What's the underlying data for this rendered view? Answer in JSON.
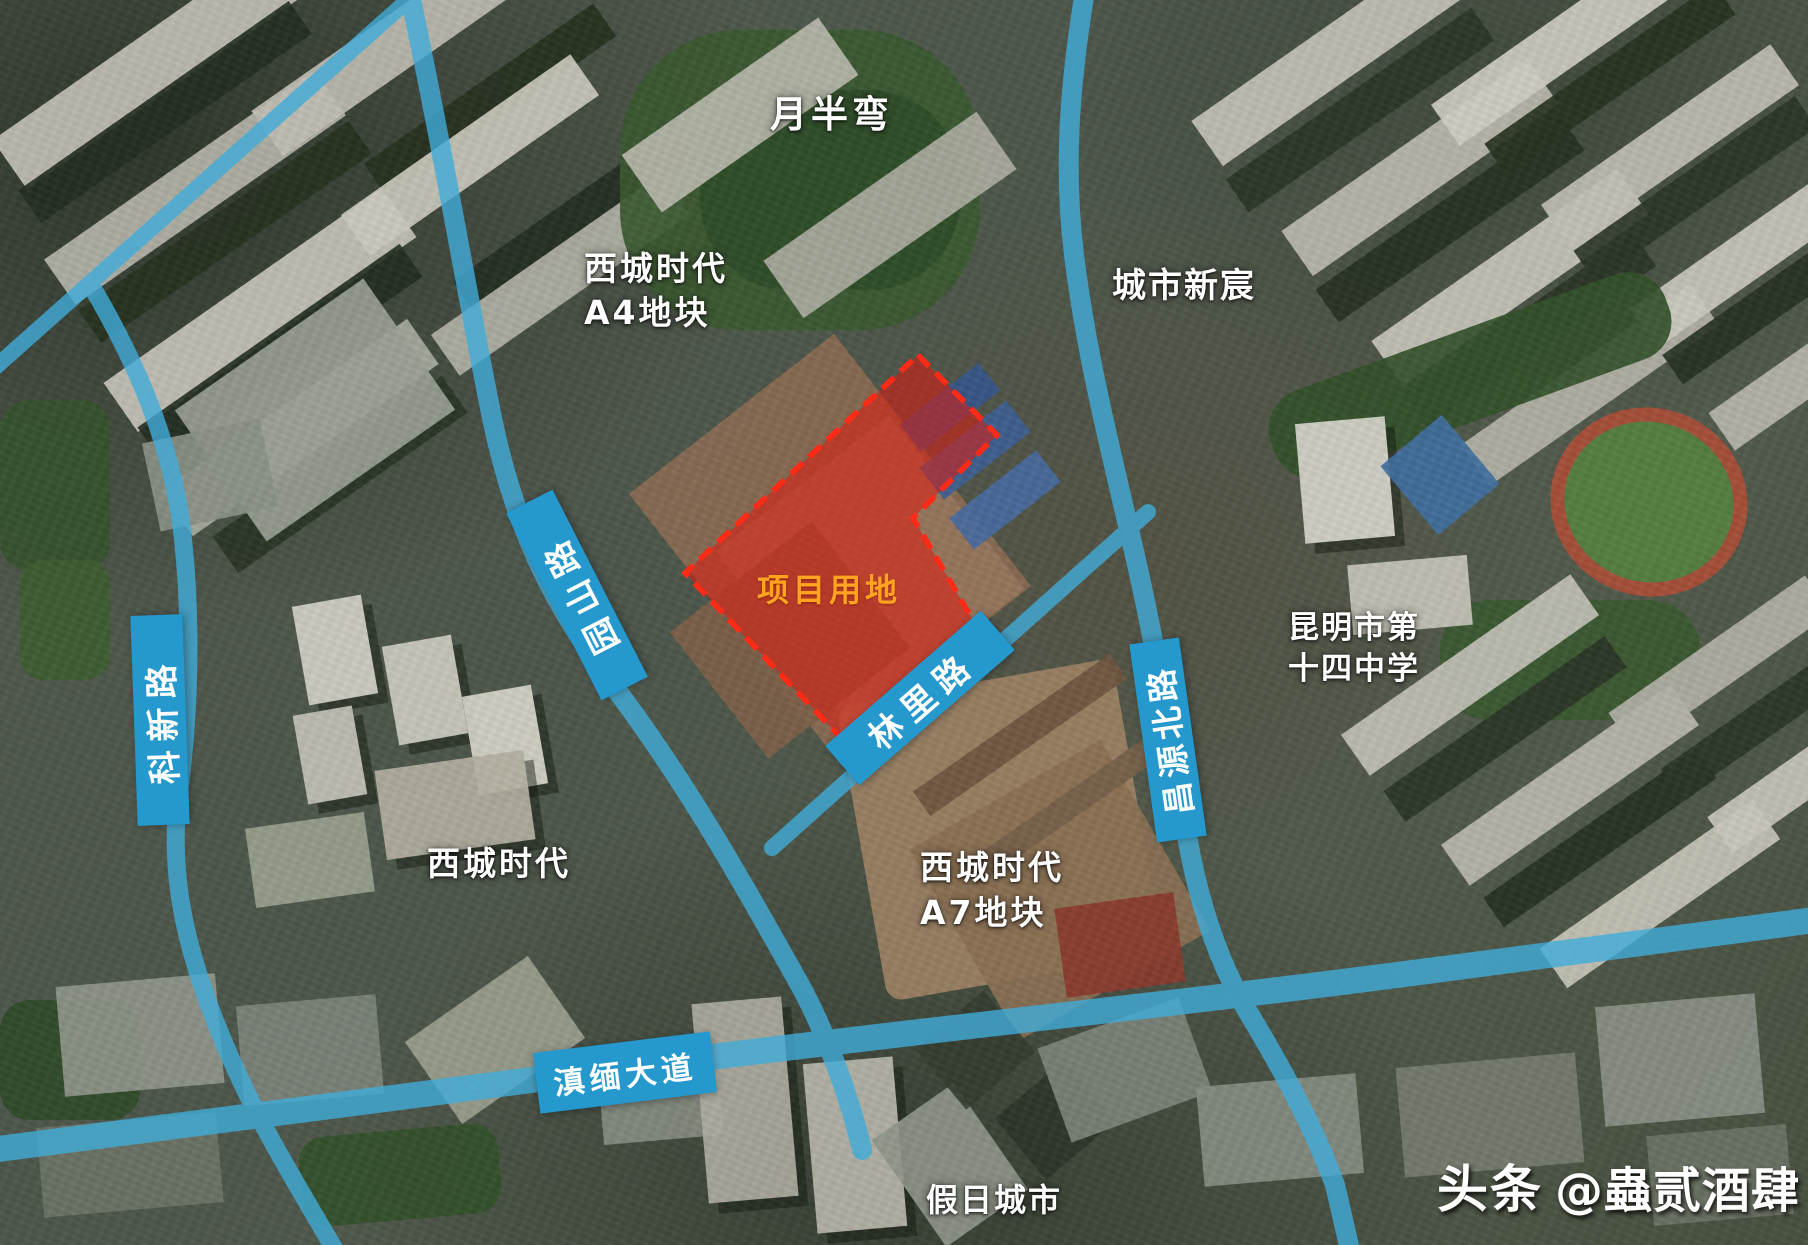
{
  "roads": {
    "yuanshan_label": "园山路",
    "kexin_label": "科新路",
    "changyuan_label": "昌源北路",
    "linli_label": "林里路",
    "dianmian_label": "滇缅大道"
  },
  "road_style": {
    "ribbon_color": "#2598cd",
    "line_color": "#41acd9"
  },
  "places": {
    "yuebanwan": "月半弯",
    "xicheng_a4": [
      "西城时代",
      "A4地块"
    ],
    "chengshi_xinchen": "城市新宸",
    "school": [
      "昆明市第",
      "十四中学"
    ],
    "xicheng_west": "西城时代",
    "xicheng_a7": [
      "西城时代",
      "A7地块"
    ],
    "jiari_chengshi": "假日城市"
  },
  "project_area": {
    "label": "项目用地",
    "label_color": "#ffa320",
    "fill_color": "#e0190f",
    "fill_opacity": "0.55",
    "border_color": "#ff2b16"
  },
  "watermark": {
    "brand": "头条",
    "handle": "@蟲贰酒肆"
  }
}
